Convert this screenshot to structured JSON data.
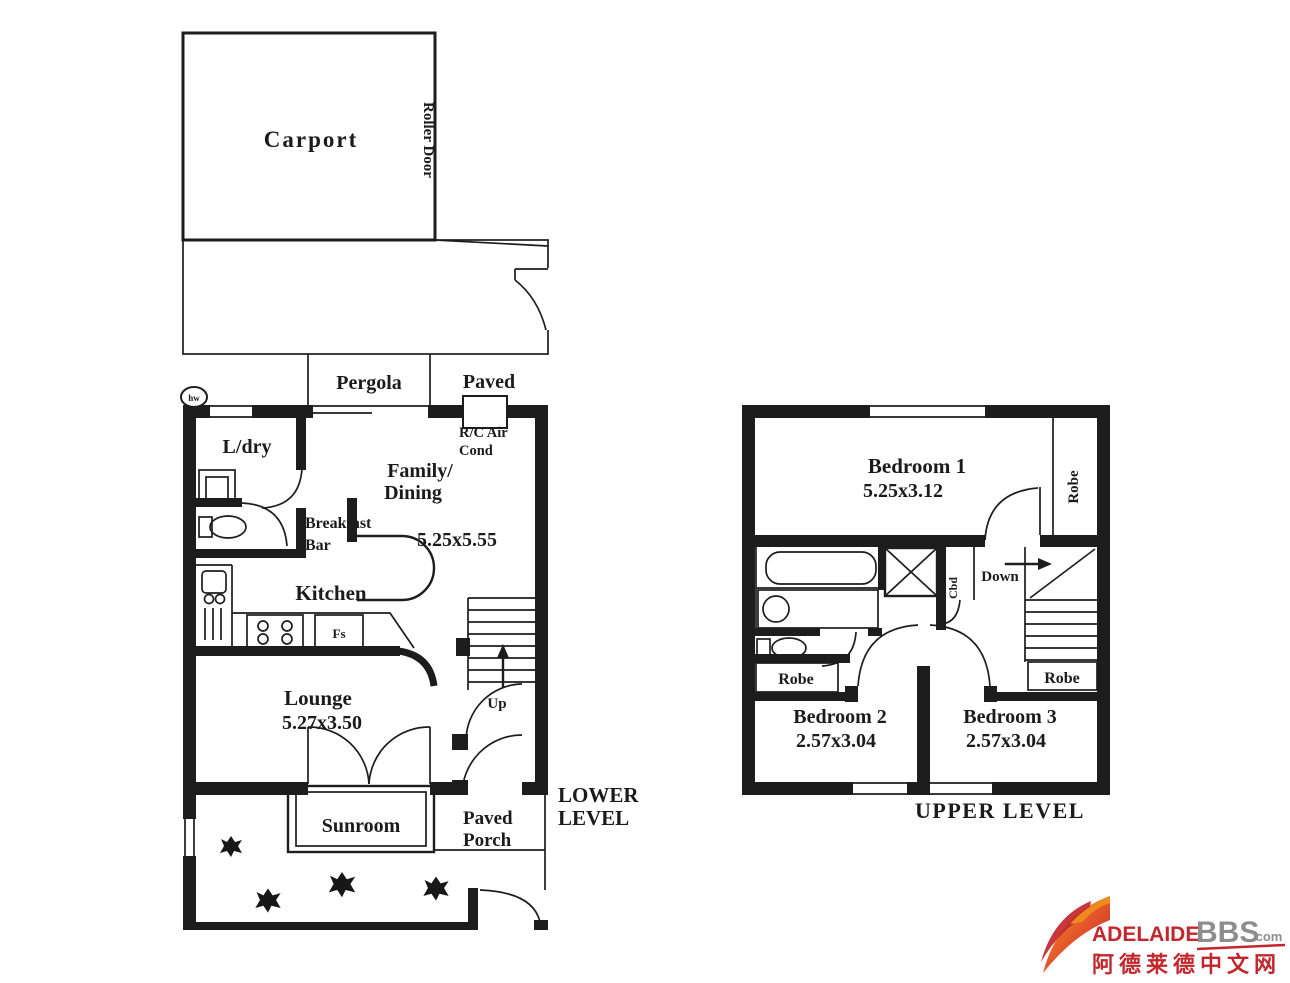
{
  "colors": {
    "ink": "#1d1d1d",
    "logo_red": "#c1272d",
    "logo_orange": "#ef8b1d",
    "logo_gray": "#8d8d8d"
  },
  "lower": {
    "title_line1": "LOWER",
    "title_line2": "LEVEL",
    "carport": "Carport",
    "roller_door": "Roller Door",
    "pergola": "Pergola",
    "paved": "Paved",
    "hw": "hw",
    "ldry": "L/dry",
    "rc_air_line1": "R/C Air",
    "rc_air_line2": "Cond",
    "family_line1": "Family/",
    "family_line2": "Dining",
    "family_dim": "5.25x5.55",
    "breakfast_line1": "Breakfast",
    "breakfast_line2": "Bar",
    "kitchen": "Kitchen",
    "fs": "Fs",
    "lounge": "Lounge",
    "lounge_dim": "5.27x3.50",
    "up": "Up",
    "sunroom": "Sunroom",
    "porch_line1": "Paved",
    "porch_line2": "Porch"
  },
  "upper": {
    "title": "UPPER LEVEL",
    "bedroom1": "Bedroom 1",
    "bedroom1_dim": "5.25x3.12",
    "robe_top": "Robe",
    "cbd": "Cbd",
    "down": "Down",
    "robe_left": "Robe",
    "robe_right": "Robe",
    "bedroom2": "Bedroom 2",
    "bedroom2_dim": "2.57x3.04",
    "bedroom3": "Bedroom 3",
    "bedroom3_dim": "2.57x3.04"
  },
  "brand": {
    "adelaide": "ADELAIDE",
    "bbs": "BBS",
    "com": ".com",
    "chinese": "阿德莱德中文网"
  }
}
